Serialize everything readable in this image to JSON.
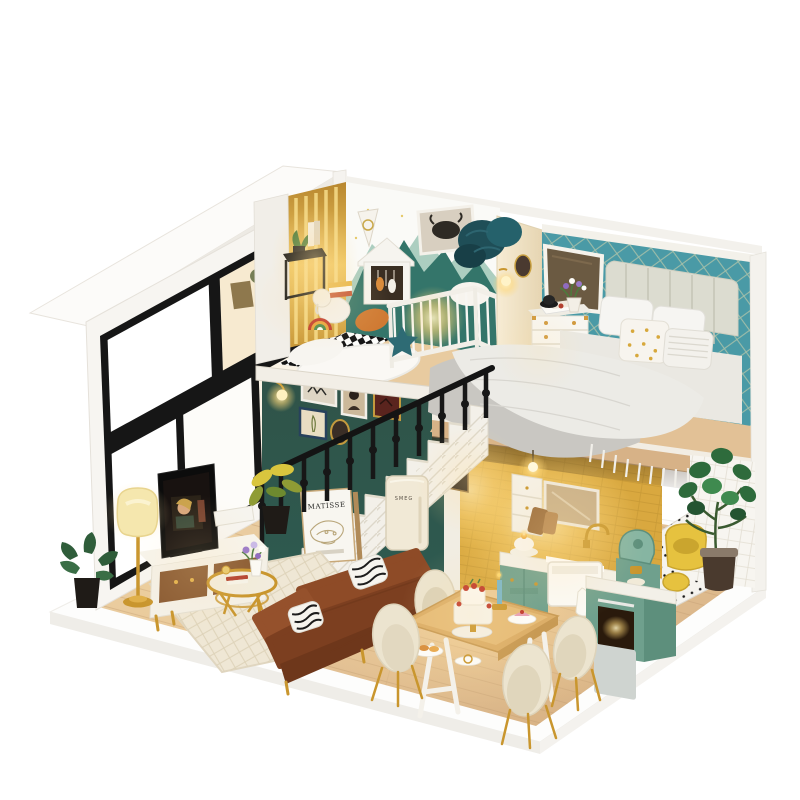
{
  "image": {
    "kind": "photograph",
    "subject": "miniature DIY dollhouse loft diorama with warm LED lighting",
    "view": "three-quarter isometric on plain white studio background"
  },
  "visible_text": {
    "poster_title": "MATISSE",
    "fridge_logo": "SMEG"
  },
  "palette": {
    "background": "#ffffff",
    "shell_white": "#f4f1ec",
    "bedroom_wall_teal": "#4a9aa6",
    "gallery_wall_green": "#2e5a50",
    "kitchen_tile_yellow": "#e0ae48",
    "cabinet_sage": "#6fa08d",
    "wood_floor": "#e2c094",
    "sofa_leather_brown": "#8a4a28",
    "accent_gold": "#c9962e",
    "warm_light": "#ffd878",
    "knit_blanket_teal": "#1f4e57",
    "railing_black": "#171717"
  },
  "rooms": {
    "nursery_loft": {
      "items": [
        "white crib",
        "house-shaped wardrobe",
        "highland-cow picture",
        "pennant banner",
        "mountain wallpaper",
        "rainbow toy",
        "plush elephant",
        "teal star pillow",
        "orange pillow",
        "fluffy white rug",
        "black side table with plant and books",
        "checkerboard floor"
      ]
    },
    "bedroom_loft": {
      "items": [
        "channel-tufted headboard bed",
        "grey quilted duvet with fringe",
        "gold-dot pillow",
        "white dresser with gold trim",
        "vanity mirror",
        "flower pot",
        "wall sconce",
        "oval portrait",
        "slippers",
        "teal lattice wallpaper"
      ]
    },
    "living_room": {
      "items": [
        "gallery wall with five frames",
        "wall sconce",
        "black stair railing",
        "white geometric staircase",
        "MATISSE poster",
        "retro fridge",
        "floor lamp",
        "television",
        "tv console",
        "gold coffee table",
        "flower vase",
        "cream diamond rug",
        "brown leather sofa",
        "zebra pillows",
        "monstera plant",
        "croton plant"
      ]
    },
    "kitchen": {
      "items": [
        "yellow subway tiles",
        "pendant bulb",
        "white cabinet",
        "window mirror",
        "gold faucet",
        "farmhouse sink",
        "sage base cabinets",
        "green espresso machine",
        "oven island",
        "cake on stovetop",
        "hand towel"
      ]
    },
    "dining_area": {
      "items": [
        "wood dining table with white A-frame legs",
        "four cream shell chairs with gold legs",
        "tiered strawberry cake",
        "dessert plates",
        "blue candle"
      ]
    },
    "right_corner": {
      "items": [
        "fiddle-leaf fig plant",
        "yellow tub chair",
        "perforated dotted floor",
        "white grid wall"
      ]
    }
  }
}
